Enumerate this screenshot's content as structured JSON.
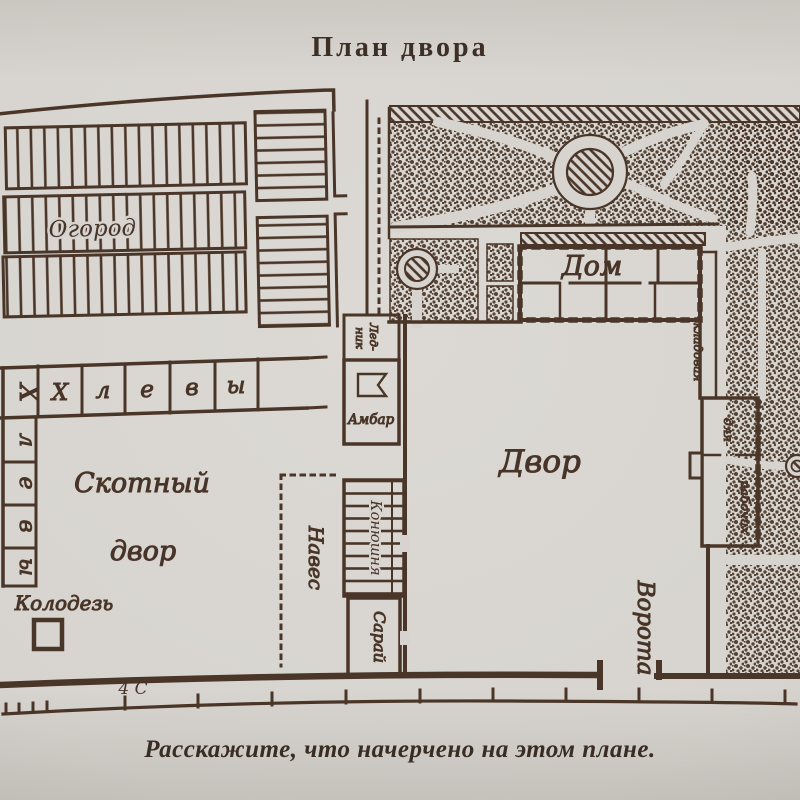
{
  "page": {
    "title": "План двора",
    "caption": "Расскажите, что начерчено на этом плане."
  },
  "colors": {
    "ink": "#4a3628",
    "paper": "#d7d4cf"
  },
  "plan": {
    "garden": "Огород",
    "sheds_row": [
      "Х",
      "л",
      "е",
      "в",
      "ы"
    ],
    "sheds_col": [
      "Х",
      "л",
      "е",
      "в",
      "ы"
    ],
    "cattle_yard_line1": "Скотный",
    "cattle_yard_line2": "двор",
    "well": "Колодезь",
    "canopy": "Навес",
    "ice_cellar_line1": "Лед-",
    "ice_cellar_line2": "ник",
    "barn": "Амбар",
    "stable": "Конюшня",
    "shed": "Сарай",
    "yard": "Двор",
    "gates": "Ворота",
    "house": "Дом",
    "pantry": "кладовая",
    "workers_line1": "для",
    "workers_line2": "рабочих",
    "scale_mark": "4 С"
  }
}
